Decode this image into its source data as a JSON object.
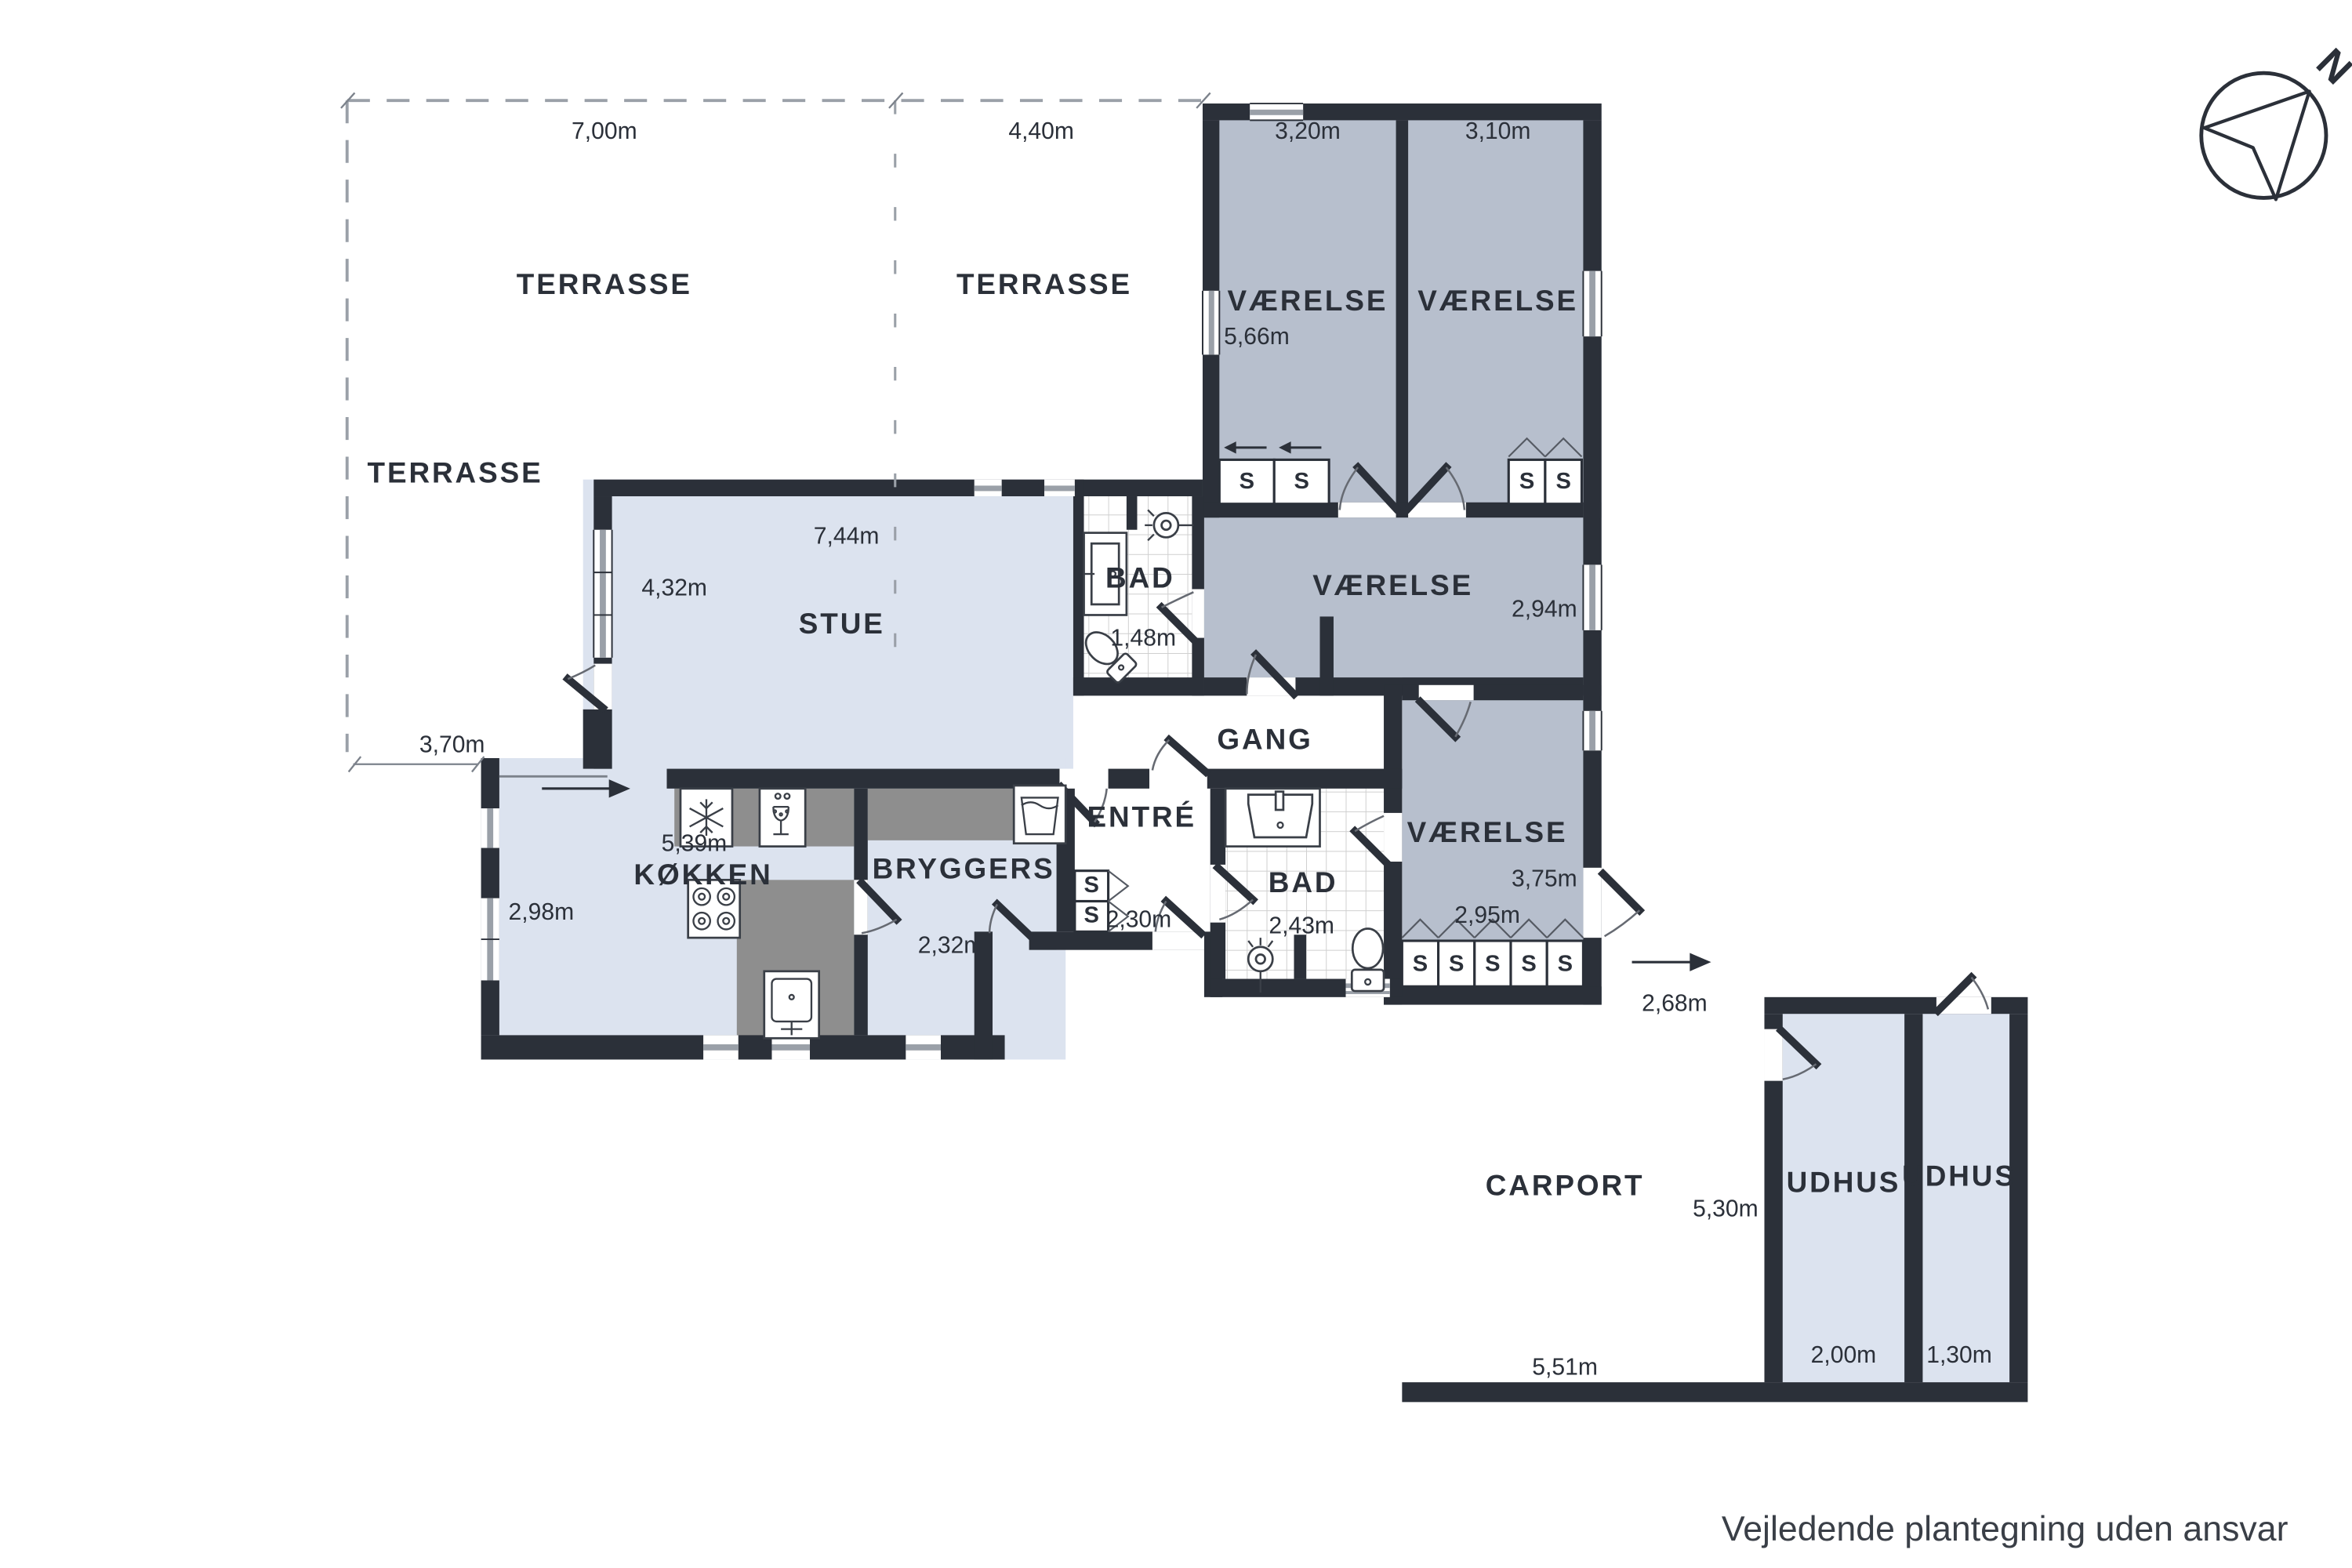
{
  "footer_note": "Vejledende plantegning uden ansvar",
  "compass": {
    "north_label": "N"
  },
  "closet_letter": "S",
  "path_dimension": "2,68m",
  "terraces": {
    "t1": {
      "label": "TERRASSE",
      "width": "7,00m"
    },
    "t2": {
      "label": "TERRASSE",
      "width": "4,40m"
    },
    "t3": {
      "label": "TERRASSE",
      "width": "3,70m"
    }
  },
  "rooms": {
    "bedroom1": {
      "label": "VÆRELSE",
      "width": "3,20m",
      "depth": "5,66m"
    },
    "bedroom2": {
      "label": "VÆRELSE",
      "width": "3,10m"
    },
    "bedroom3": {
      "label": "VÆRELSE",
      "depth": "2,94m"
    },
    "bath1": {
      "label": "BAD",
      "width": "1,48m"
    },
    "stue": {
      "label": "STUE",
      "width": "7,44m",
      "depth": "4,32m"
    },
    "gang": {
      "label": "GANG"
    },
    "kokken": {
      "label": "KØKKEN",
      "width": "5,39m",
      "depth": "2,98m"
    },
    "bryggers": {
      "label": "BRYGGERS",
      "width": "2,32m"
    },
    "entre": {
      "label": "ENTRÉ",
      "width": "2,30m"
    },
    "bath2": {
      "label": "BAD",
      "width": "2,43m"
    },
    "bedroom4": {
      "label": "VÆRELSE",
      "depth": "3,75m",
      "width": "2,95m"
    },
    "carport": {
      "label": "CARPORT",
      "width": "5,51m",
      "depth": "5,30m"
    },
    "udhus1": {
      "label": "UDHUS",
      "width": "2,00m"
    },
    "udhus2": {
      "label": "UDHUS",
      "width": "1,30m"
    }
  },
  "colors": {
    "wall": "#2b3039",
    "bedroom_fill": "#b7bfcd",
    "light_fill": "#dce3ef",
    "counter": "#8e8e8e"
  }
}
